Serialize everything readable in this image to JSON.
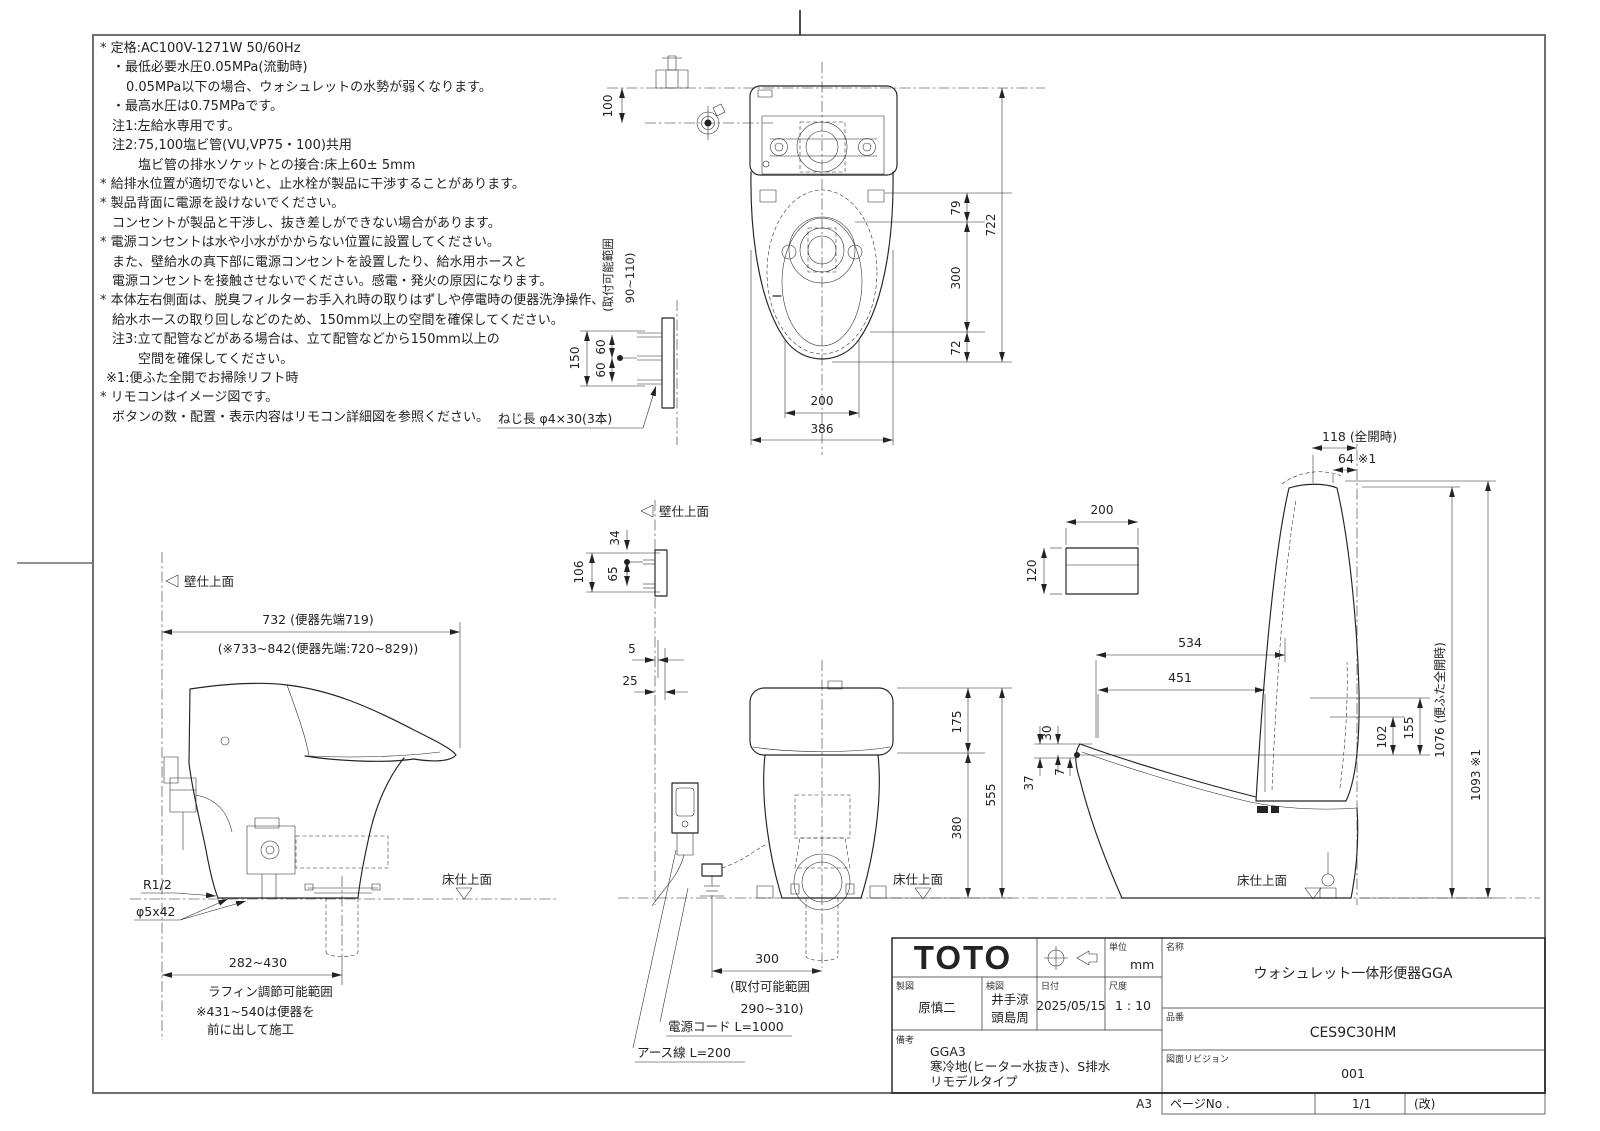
{
  "frame": {
    "size_label": "A3"
  },
  "notes": {
    "lines": [
      "* 定格:AC100V-1271W 50/60Hz",
      "・最低必要水圧0.05MPa(流動時)",
      "0.05MPa以下の場合、ウォシュレットの水勢が弱くなります。",
      "・最高水圧は0.75MPaです。",
      "注1:左給水専用です。",
      "注2:75,100塩ビ管(VU,VP75・100)共用",
      "塩ビ管の排水ソケットとの接合:床上60± 5mm",
      "* 給排水位置が適切でないと、止水栓が製品に干渉することがあります。",
      "* 製品背面に電源を設けないでください。",
      "コンセントが製品と干渉し、抜き差しができない場合があります。",
      "* 電源コンセントは水や小水がかからない位置に設置してください。",
      "また、壁給水の真下部に電源コンセントを設置したり、給水用ホースと",
      "電源コンセントを接触させないでください。感電・発火の原因になります。",
      "* 本体左右側面は、脱臭フィルターお手入れ時の取りはずしや停電時の便器洗浄操作、",
      "給水ホースの取り回しなどのため、150mm以上の空間を確保してください。",
      "注3:立て配管などがある場合は、立て配管などから150mm以上の",
      "空間を確保してください。",
      "※1:便ふた全開でお掃除リフト時",
      "* リモコンはイメージ図です。",
      "ボタンの数・配置・表示内容はリモコン詳細図を参照ください。"
    ]
  },
  "plate_detail": {
    "dim_150": "150",
    "dim_60_top": "60",
    "dim_60_bottom": "60",
    "screw_note": "ねじ長 φ4×30(3本)"
  },
  "top_view": {
    "dim_100": "100",
    "range_line1": "(取付可能範囲",
    "range_line2": "90~110)",
    "dim_79": "79",
    "dim_300": "300",
    "dim_72": "72",
    "dim_722": "722",
    "dim_200": "200",
    "dim_386": "386"
  },
  "side_left": {
    "wall_label": "壁仕上面",
    "floor_label": "床仕上面",
    "dim_732": "732 (便器先端719)",
    "dim_alt": "(※733~842(便器先端:720~829))",
    "thread_label": "R1/2",
    "screw_label": "φ5x42",
    "dim_282": "282~430",
    "note1": "ラフィン調節可能範囲",
    "note2": "※431~540は便器を",
    "note3": "前に出して施工"
  },
  "front_view": {
    "wall_label": "壁仕上面",
    "floor_label": "床仕上面",
    "dim_34": "34",
    "dim_106": "106",
    "dim_65": "65",
    "dim_5": "5",
    "dim_25": "25",
    "dim_175": "175",
    "dim_380": "380",
    "dim_555": "555",
    "dim_300": "300",
    "range_line1": "(取付可能範囲",
    "range_line2": "290~310)",
    "cord_label": "電源コード L=1000",
    "earth_label": "アース線 L=200"
  },
  "side_right": {
    "floor_label": "床仕上面",
    "dim_118": "118 (全開時)",
    "dim_64": "64 ※1",
    "remote_200": "200",
    "remote_120": "120",
    "dim_534": "534",
    "dim_451": "451",
    "dim_30": "30",
    "dim_7": "7",
    "dim_37": "37",
    "dim_102": "102",
    "dim_155": "155",
    "dim_1076": "1076 (便ふた全開時)",
    "dim_1093": "1093 ※1"
  },
  "title_block": {
    "logo": "TOTO",
    "unit_label": "単位",
    "unit_value": "mm",
    "drawn_label": "製図",
    "drawn_value": "原慎二",
    "checked_label": "検図",
    "checked_value1": "井手涼",
    "checked_value2": "頭島周",
    "date_label": "日付",
    "date_value": "2025/05/15",
    "scale_label": "尺度",
    "scale_value": "1 : 10",
    "name_label": "名称",
    "name_value": "ウォシュレット一体形便器GGA",
    "part_label": "品番",
    "part_value": "CES9C30HM",
    "revision_label": "図面リビジョン",
    "revision_value": "001",
    "remarks_label": "備考",
    "remarks_line1": "GGA3",
    "remarks_line2": "寒冷地(ヒーター水抜き)、S排水",
    "remarks_line3": "リモデルタイプ",
    "page_label": "ページNo .",
    "page_value": "1/1",
    "kai_label": "(改)"
  }
}
